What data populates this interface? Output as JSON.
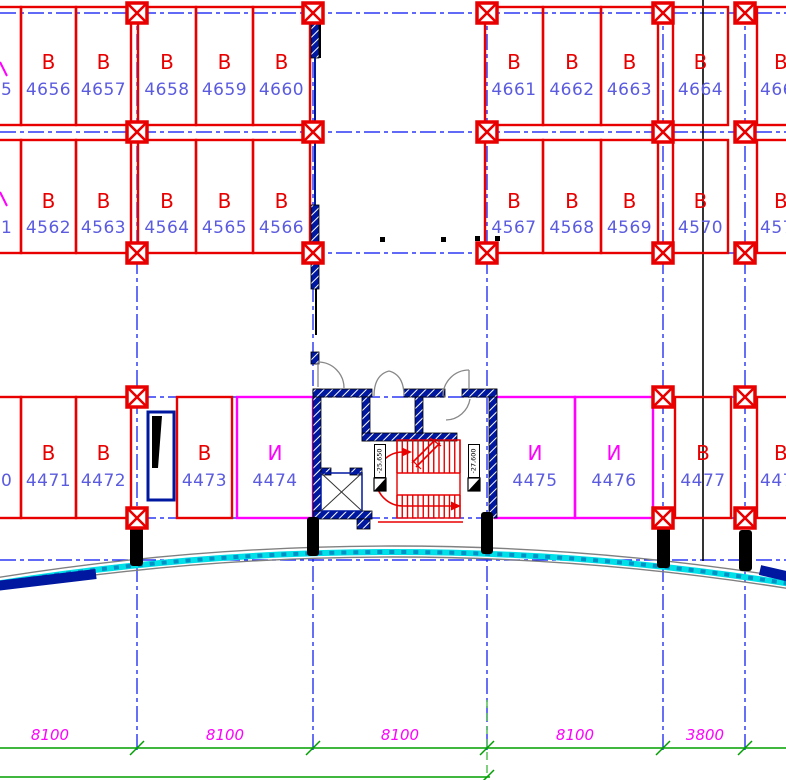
{
  "drawing_type": "parking-floor-plan",
  "colors": {
    "stall_red": "#e80000",
    "number_blue": "#5b5bdf",
    "grid_blue": "#0010f0",
    "magenta": "#ff00ff",
    "dim_green": "#00a000",
    "facade_cyan": "#00e0e8",
    "wall_navy": "#0018a0",
    "door_gray": "#888888",
    "black": "#000000"
  },
  "rows": [
    {
      "stalls": [
        {
          "letter": "",
          "number": "5",
          "type": "b"
        },
        {
          "letter": "В",
          "number": "4656",
          "type": "b"
        },
        {
          "letter": "В",
          "number": "4657",
          "type": "b"
        },
        {
          "letter": "В",
          "number": "4658",
          "type": "b"
        },
        {
          "letter": "В",
          "number": "4659",
          "type": "b"
        },
        {
          "letter": "В",
          "number": "4660",
          "type": "b"
        },
        {
          "letter": "В",
          "number": "4661",
          "type": "b"
        },
        {
          "letter": "В",
          "number": "4662",
          "type": "b"
        },
        {
          "letter": "В",
          "number": "4663",
          "type": "b"
        },
        {
          "letter": "В",
          "number": "4664",
          "type": "b"
        },
        {
          "letter": "В",
          "number": "466",
          "type": "b"
        }
      ]
    },
    {
      "stalls": [
        {
          "letter": "",
          "number": "1",
          "type": "b"
        },
        {
          "letter": "В",
          "number": "4562",
          "type": "b"
        },
        {
          "letter": "В",
          "number": "4563",
          "type": "b"
        },
        {
          "letter": "В",
          "number": "4564",
          "type": "b"
        },
        {
          "letter": "В",
          "number": "4565",
          "type": "b"
        },
        {
          "letter": "В",
          "number": "4566",
          "type": "b"
        },
        {
          "letter": "В",
          "number": "4567",
          "type": "b"
        },
        {
          "letter": "В",
          "number": "4568",
          "type": "b"
        },
        {
          "letter": "В",
          "number": "4569",
          "type": "b"
        },
        {
          "letter": "В",
          "number": "4570",
          "type": "b"
        },
        {
          "letter": "В",
          "number": "457",
          "type": "b"
        }
      ]
    },
    {
      "stalls": [
        {
          "letter": "",
          "number": "0",
          "type": "b"
        },
        {
          "letter": "В",
          "number": "4471",
          "type": "b"
        },
        {
          "letter": "В",
          "number": "4472",
          "type": "b"
        },
        {
          "letter": "В",
          "number": "4473",
          "type": "b"
        },
        {
          "letter": "И",
          "number": "4474",
          "type": "i"
        },
        {
          "letter": "И",
          "number": "4475",
          "type": "i"
        },
        {
          "letter": "И",
          "number": "4476",
          "type": "i"
        },
        {
          "letter": "В",
          "number": "4477",
          "type": "b"
        },
        {
          "letter": "В",
          "number": "447",
          "type": "b"
        }
      ]
    }
  ],
  "levels": {
    "left": "-25,650",
    "right": "-27,600"
  },
  "dimensions": {
    "values": [
      "8100",
      "8100",
      "8100",
      "8100",
      "3800"
    ]
  }
}
